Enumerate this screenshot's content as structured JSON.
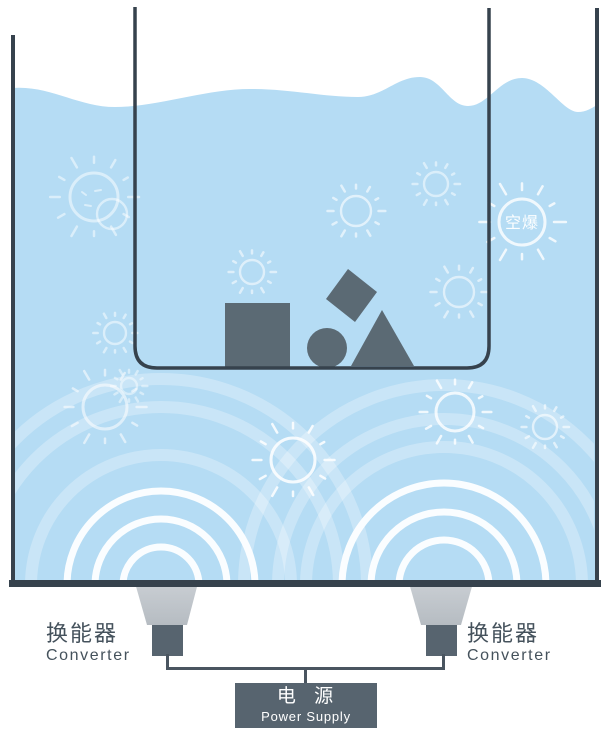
{
  "title": "ultrasonic-cleaning-cavitation-diagram",
  "colors": {
    "water": "#b5dcf4",
    "outline": "#36424d",
    "object": "#5b6a74",
    "transducer_light": "#c9ced3",
    "transducer_light_deep": "#b6bcc2",
    "transducer_dark": "#57646f",
    "wire": "#4a5560",
    "label_text": "#45525c",
    "power_box": "#57646f",
    "power_text": "#ffffff",
    "wave_bright": "rgba(255,255,255,0.93)",
    "wave_soft": "rgba(255,255,255,0.28)"
  },
  "labels": {
    "cavitation": "空爆",
    "converter_left": {
      "zh": "换能器",
      "en": "Converter"
    },
    "converter_right": {
      "zh": "换能器",
      "en": "Converter"
    },
    "power_supply": {
      "zh": "电 源",
      "en": "Power Supply"
    }
  },
  "diagram": {
    "water_path": "M12,88 C50,85 78,107 115,107 C158,107 205,89 250,89 C292,89 322,97 358,97 C383,97 396,77 420,77 C441,77 449,106 468,106 C488,106 499,78 522,78 C545,78 563,112 578,112 C586,112 592,108 597,105 L597,582 L12,582 Z",
    "beaker_path": "M135,7 L135,346 Q135,368 157,368 L467,368 Q489,368 489,346 L489,8",
    "tank": {
      "left_x": 13,
      "right_x": 597,
      "left_top_y": 35,
      "right_top_y": 8,
      "wall_bottom_y": 584,
      "wall_w": 4,
      "bottom": {
        "x": 9,
        "y": 580,
        "w": 592,
        "h": 7
      }
    },
    "objects": [
      {
        "type": "square",
        "x": 225,
        "y": 303,
        "w": 65,
        "h": 64
      },
      {
        "type": "rotated-square",
        "points": "348,269 377,292 355,322 326,299"
      },
      {
        "type": "circle",
        "cx": 327,
        "cy": 348,
        "r": 20
      },
      {
        "type": "triangle",
        "points": "351,366 414,366 382,310"
      }
    ],
    "bubbles": [
      {
        "x": 94,
        "y": 197,
        "r": 24,
        "style": "double",
        "o": 0.5
      },
      {
        "x": 115,
        "y": 333,
        "r": 11,
        "style": "burst",
        "o": 0.5
      },
      {
        "x": 105,
        "y": 407,
        "r": 22,
        "style": "burst",
        "o": 0.55
      },
      {
        "x": 129,
        "y": 386,
        "r": 8,
        "style": "burst",
        "o": 0.45
      },
      {
        "x": 252,
        "y": 272,
        "r": 12,
        "style": "burst",
        "o": 0.55
      },
      {
        "x": 356,
        "y": 211,
        "r": 15,
        "style": "burst",
        "o": 0.6
      },
      {
        "x": 436,
        "y": 184,
        "r": 12,
        "style": "burst",
        "o": 0.5
      },
      {
        "x": 459,
        "y": 292,
        "r": 15,
        "style": "burst",
        "o": 0.55
      },
      {
        "x": 522,
        "y": 222,
        "r": 23,
        "style": "labeled",
        "o": 0.8
      },
      {
        "x": 293,
        "y": 460,
        "r": 22,
        "style": "burst",
        "o": 0.85
      },
      {
        "x": 455,
        "y": 412,
        "r": 19,
        "style": "burst",
        "o": 0.8
      },
      {
        "x": 545,
        "y": 427,
        "r": 12,
        "style": "burst",
        "o": 0.6
      }
    ],
    "wave_sets": [
      {
        "id": "left",
        "cx": 161,
        "cy": 585,
        "bright": [
          38,
          66,
          94
        ],
        "soft": [
          130,
          178,
          206
        ]
      },
      {
        "id": "right",
        "cx": 444,
        "cy": 585,
        "bright": [
          45,
          73,
          102
        ],
        "soft": [
          138,
          166,
          200
        ]
      }
    ],
    "transducers": [
      {
        "id": "left",
        "trapezoid": "M135,583 L198,583 L187,625 L147,625 Z",
        "block": {
          "x": 152,
          "y": 625,
          "w": 31,
          "h": 31
        }
      },
      {
        "id": "right",
        "trapezoid": "M409,583 L473,583 L461,625 L421,625 Z",
        "block": {
          "x": 426,
          "y": 625,
          "w": 31,
          "h": 31
        }
      }
    ],
    "wires_path": "M167.5,654 L167.5,668.5 L443.5,668.5 L443.5,654 M305.5,668.5 L305.5,684"
  }
}
